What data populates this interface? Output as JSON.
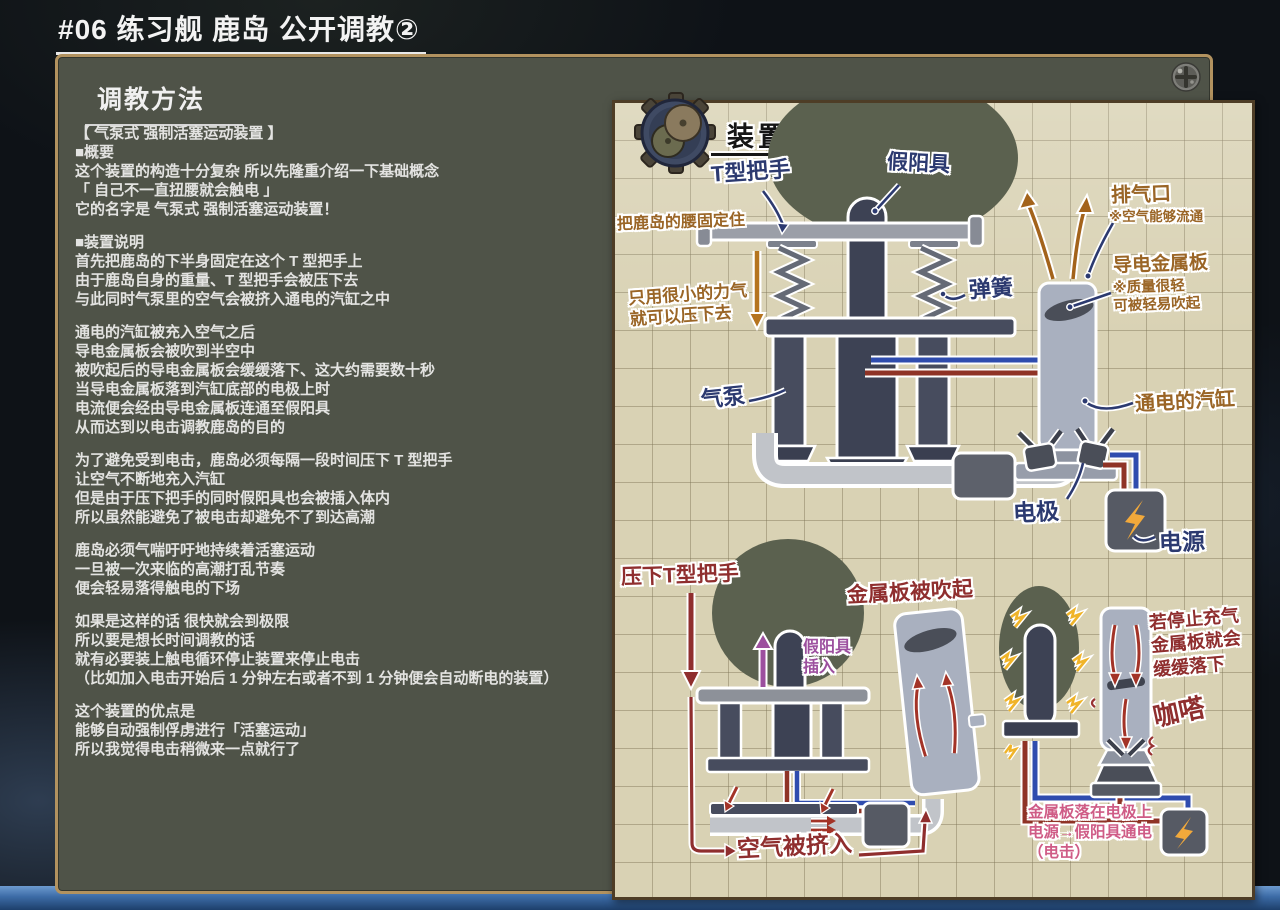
{
  "page": {
    "title": "#06 练习舰 鹿岛 公开调教②"
  },
  "article": {
    "heading": "调教方法",
    "paragraphs": [
      "【 气泵式 强制活塞运动装置 】\n■概要\n这个装置的构造十分复杂 所以先隆重介绍一下基础概念\n「 自己不一直扭腰就会触电 」\n它的名字是 气泵式 强制活塞运动装置！",
      "■装置说明\n首先把鹿岛的下半身固定在这个 T 型把手上\n由于鹿岛自身的重量、T 型把手会被压下去\n与此同时气泵里的空气会被挤入通电的汽缸之中",
      "通电的汽缸被充入空气之后\n导电金属板会被吹到半空中\n被吹起后的导电金属板会缓缓落下、这大约需要数十秒\n当导电金属板落到汽缸底部的电极上时\n电流便会经由导电金属板连通至假阳具\n从而达到以电击调教鹿岛的目的",
      "为了避免受到电击，鹿岛必须每隔一段时间压下 T 型把手\n让空气不断地充入汽缸\n但是由于压下把手的同时假阳具也会被插入体内\n所以虽然能避免了被电击却避免不了到达高潮",
      "鹿岛必须气喘吁吁地持续着活塞运动\n一旦被一次来临的高潮打乱节奏\n便会轻易落得触电的下场",
      "如果是这样的话 很快就会到极限\n所以要是想长时间调教的话\n就有必要装上触电循环停止装置来停止电击\n（比如加入电击开始后 1 分钟左右或者不到 1 分钟便会自动断电的装置）",
      "这个装置的优点是\n能够自动强制俘虏进行「活塞运动」\n所以我觉得电击稍微来一点就行了"
    ]
  },
  "diagram": {
    "title": "装置图解",
    "scene1": {
      "t_handle": "T型把手",
      "dildo": "假阳具",
      "fix_waist": "把鹿岛的腰固定住",
      "small_force": "只用很小的力气\n就可以压下去",
      "exhaust": "排气口",
      "exhaust_note": "※空气能够流通",
      "spring": "弹簧",
      "plate": "导电金属板",
      "plate_note": "※质量很轻\n可被轻易吹起",
      "pump": "气泵",
      "cylinder": "通电的汽缸",
      "electrode": "电极",
      "power": "电源"
    },
    "scene2": {
      "press": "压下T型把手",
      "blown": "金属板被吹起",
      "insert": "假阳具\n插入",
      "air_in": "空气被挤入"
    },
    "scene3": {
      "stop": "若停止充气\n金属板就会\n缓缓落下",
      "click": "咖嗒",
      "result": "金属板落在电极上\n电源→假阳具通电\n（电击）"
    }
  },
  "icons": {
    "machine_gear": "machine-gear-icon",
    "panel_screw": "screw-icon",
    "lightning_bolt": "lightning-bolt-icon"
  },
  "colors": {
    "paper": "#d9d2b4",
    "panel": "#4f5348",
    "panel_border": "#b2925f",
    "ink_navy": "#2c3a70",
    "ink_brown": "#9a6526",
    "ink_red": "#8f2e2e",
    "ink_pink": "#cf5c86",
    "ink_purple": "#9c4f9e",
    "bolt": "#f2a93b",
    "wire_red": "#8f3326",
    "wire_blue": "#2f4cae"
  }
}
